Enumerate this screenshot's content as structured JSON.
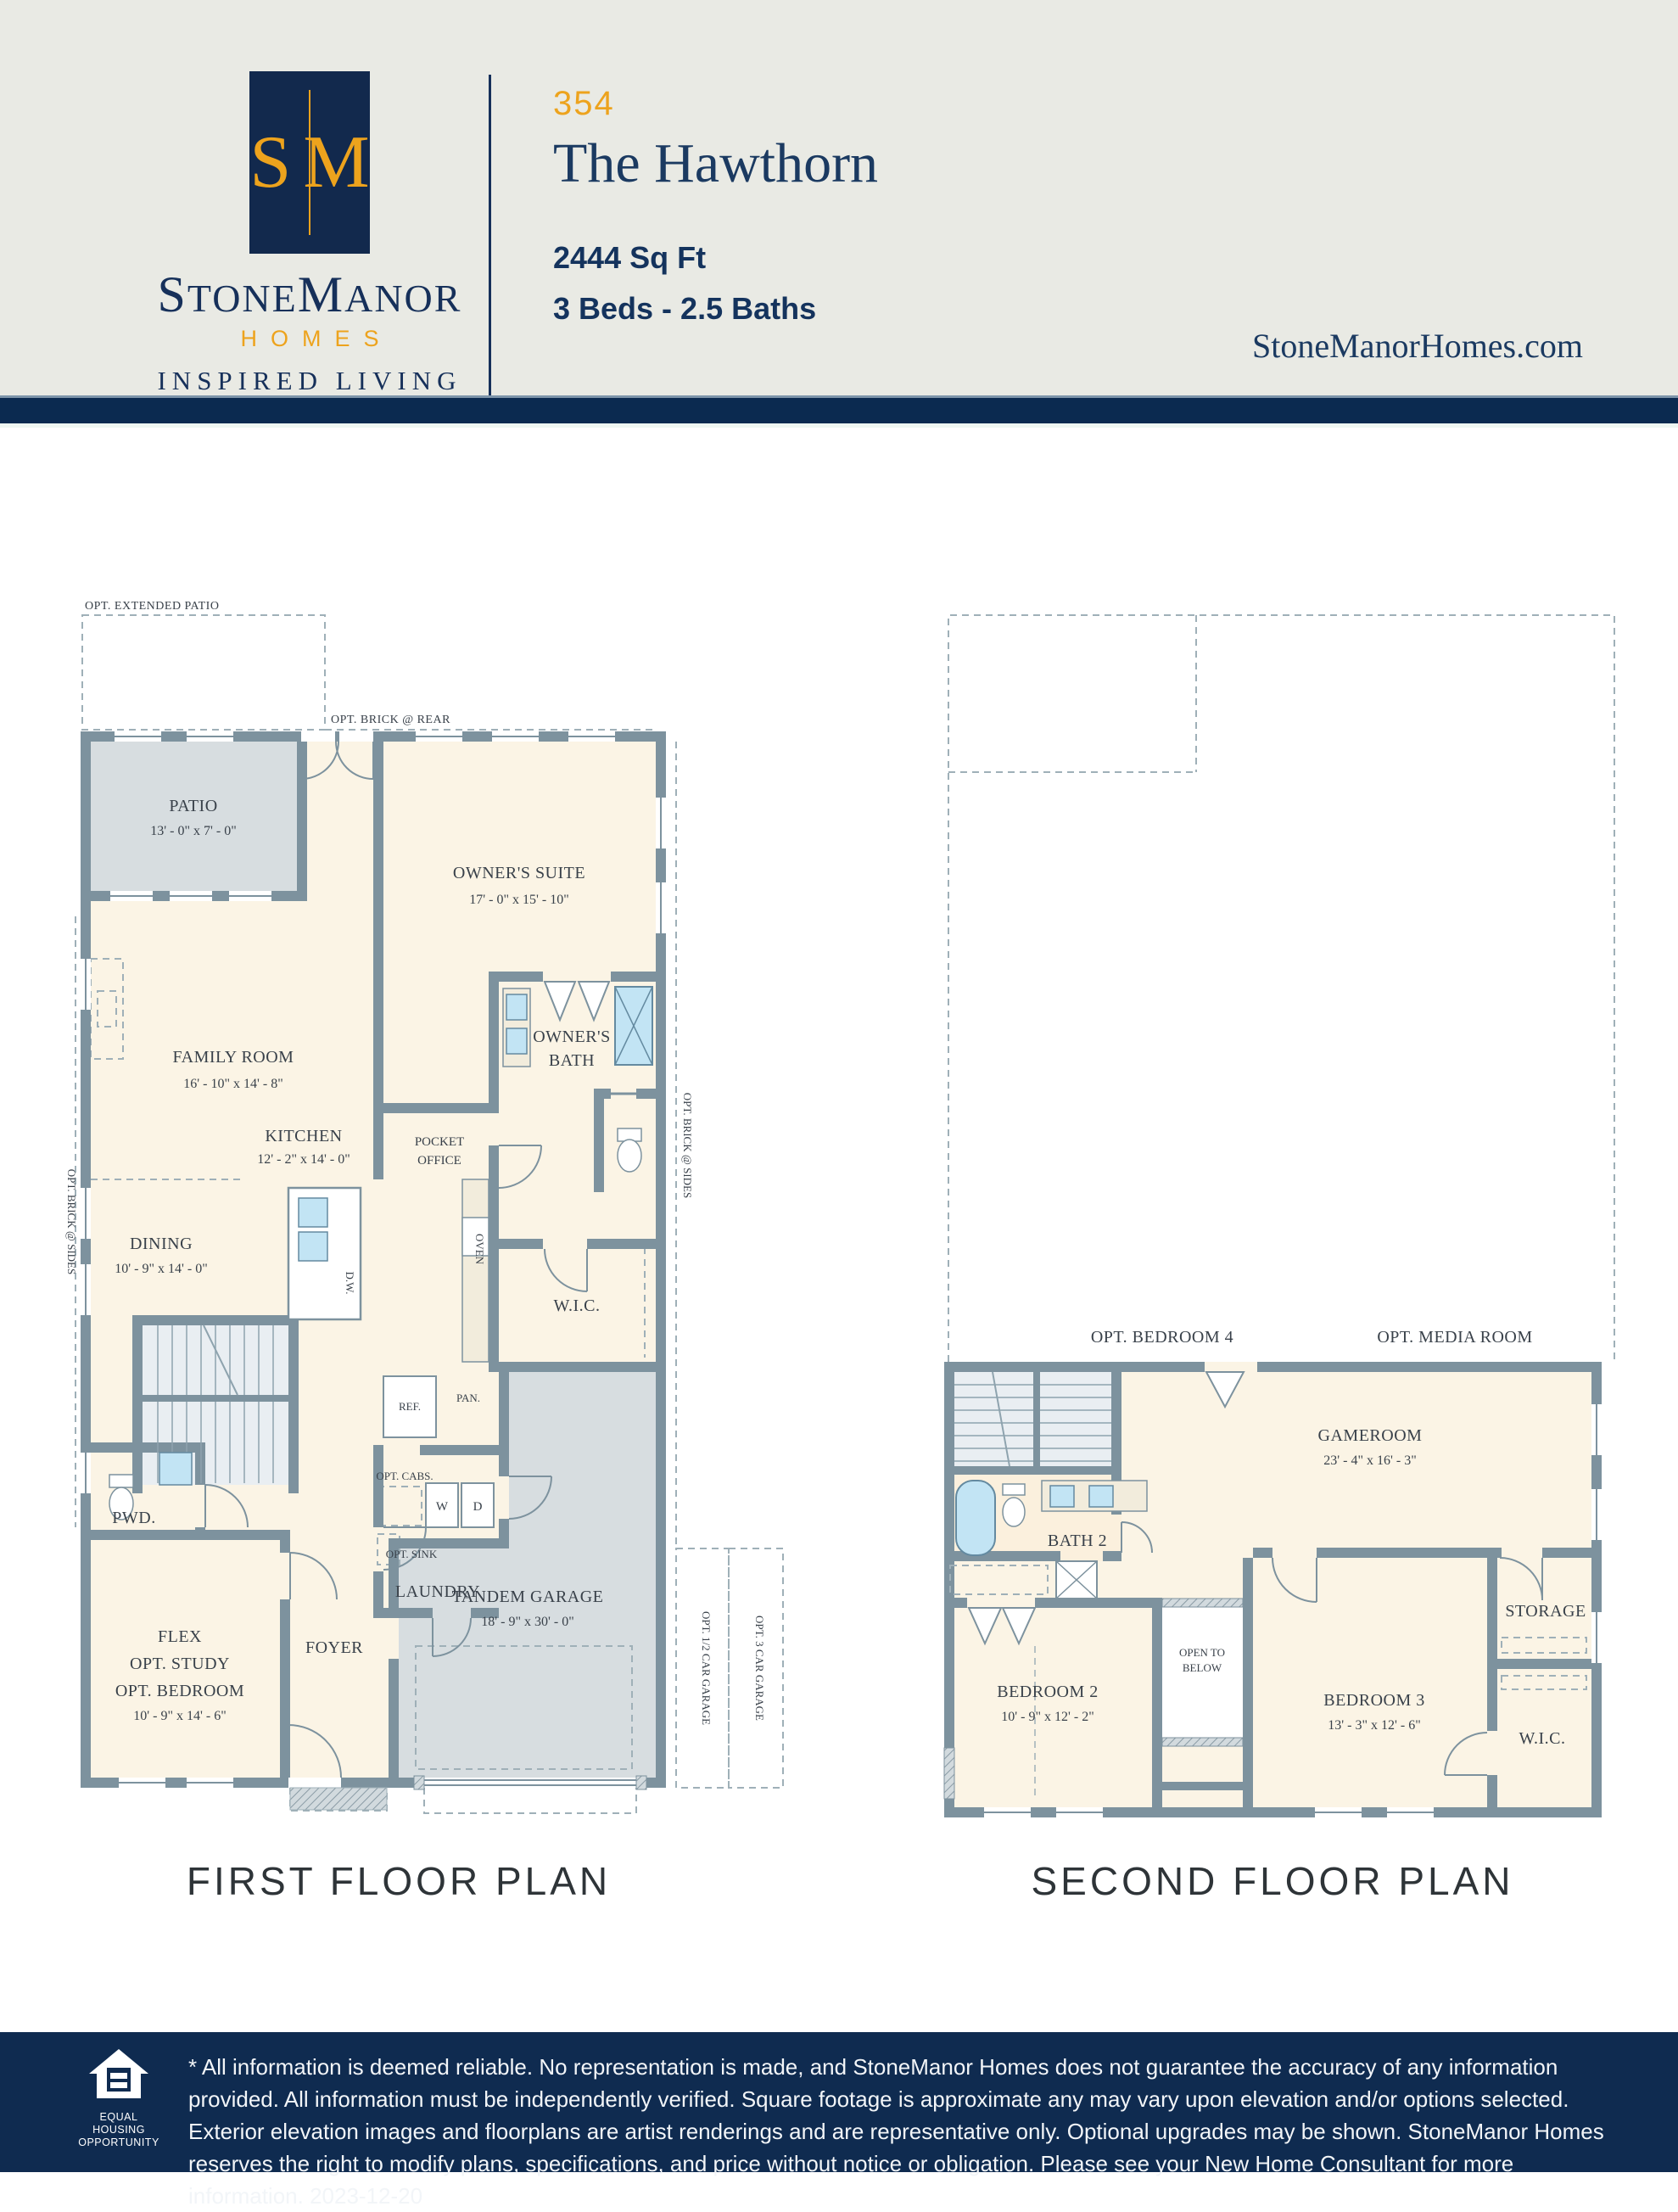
{
  "colors": {
    "navy": "#12294d",
    "gold": "#eda31d",
    "band_navy": "#0b2a50",
    "footer_navy": "#0f2b50",
    "header_bg": "#e9eae4",
    "wall": "#7d929e",
    "room_cream": "#fbf4e5",
    "floor_gray": "#d7dde0",
    "stairs_gray": "#e9eef2",
    "fixture_blue": "#c2e4f4"
  },
  "header": {
    "monogram_s": "S",
    "monogram_m": "M",
    "brand_p1": "S",
    "brand_p2": "TONE",
    "brand_p3": "M",
    "brand_p4": "ANOR",
    "homes": "HOMES",
    "tagline": "INSPIRED LIVING",
    "plan_number": "354",
    "plan_name": "The Hawthorn",
    "sqft": "2444 Sq Ft",
    "beds_baths": "3 Beds - 2.5 Baths",
    "website": "StoneManorHomes.com"
  },
  "first_floor": {
    "caption": "FIRST FLOOR PLAN",
    "labels": {
      "opt_extended_patio": "OPT. EXTENDED PATIO",
      "opt_brick_rear": "OPT. BRICK @ REAR",
      "opt_brick_sides_left": "OPT. BRICK @ SIDES",
      "opt_brick_sides_right": "OPT. BRICK @ SIDES",
      "patio": "PATIO",
      "patio_dims": "13' - 0\" x 7' - 0\"",
      "owners_suite": "OWNER'S SUITE",
      "owners_suite_dims": "17' - 0\" x 15' - 10\"",
      "family_room": "FAMILY ROOM",
      "family_room_dims": "16' - 10\" x 14' - 8\"",
      "pocket_1": "POCKET",
      "pocket_2": "OFFICE",
      "owners_bath_1": "OWNER'S",
      "owners_bath_2": "BATH",
      "kitchen": "KITCHEN",
      "kitchen_dims": "12' - 2\" x 14' - 0\"",
      "dining": "DINING",
      "dining_dims": "10' - 9\" x 14' - 0\"",
      "wic": "W.I.C.",
      "oven": "OVEN",
      "dw": "D.W.",
      "ref": "REF.",
      "pan": "PAN.",
      "opt_cabs": "OPT. CABS.",
      "opt_sink": "OPT. SINK",
      "washer": "W",
      "dryer": "D",
      "laundry": "LAUNDRY",
      "pwd": "PWD.",
      "flex": "FLEX",
      "flex_study": "OPT. STUDY",
      "flex_bedroom": "OPT. BEDROOM",
      "flex_dims": "10' - 9\" x 14' - 6\"",
      "foyer": "FOYER",
      "garage": "TANDEM GARAGE",
      "garage_dims": "18' - 9\" x 30' - 0\"",
      "opt_half_garage": "OPT. 1/2 CAR GARAGE",
      "opt_3car_garage": "OPT. 3 CAR GARAGE"
    }
  },
  "second_floor": {
    "caption": "SECOND FLOOR PLAN",
    "labels": {
      "opt_bedroom4": "OPT. BEDROOM 4",
      "opt_media_room": "OPT. MEDIA ROOM",
      "gameroom": "GAMEROOM",
      "gameroom_dims": "23' - 4\" x 16' - 3\"",
      "bath2": "BATH 2",
      "open_1": "OPEN TO",
      "open_2": "BELOW",
      "bedroom2": "BEDROOM 2",
      "bedroom2_dims": "10' - 9\" x 12' - 2\"",
      "bedroom3": "BEDROOM 3",
      "bedroom3_dims": "13' - 3\" x 12' - 6\"",
      "storage": "STORAGE",
      "wic": "W.I.C."
    }
  },
  "footer": {
    "eho_line1": "EQUAL HOUSING",
    "eho_line2": "OPPORTUNITY",
    "disclaimer": "* All information is deemed reliable. No representation is made, and StoneManor Homes does not guarantee the accuracy of any information provided. All information must be independently verified. Square footage is approximate any may vary upon elevation and/or options selected. Exterior elevation images and floorplans are artist renderings and are representative only. Optional upgrades may be shown. StoneManor Homes reserves the right to modify plans, specifications, and price without notice or obligation. Please see your New Home Consultant for more information. 2023-12-20"
  }
}
